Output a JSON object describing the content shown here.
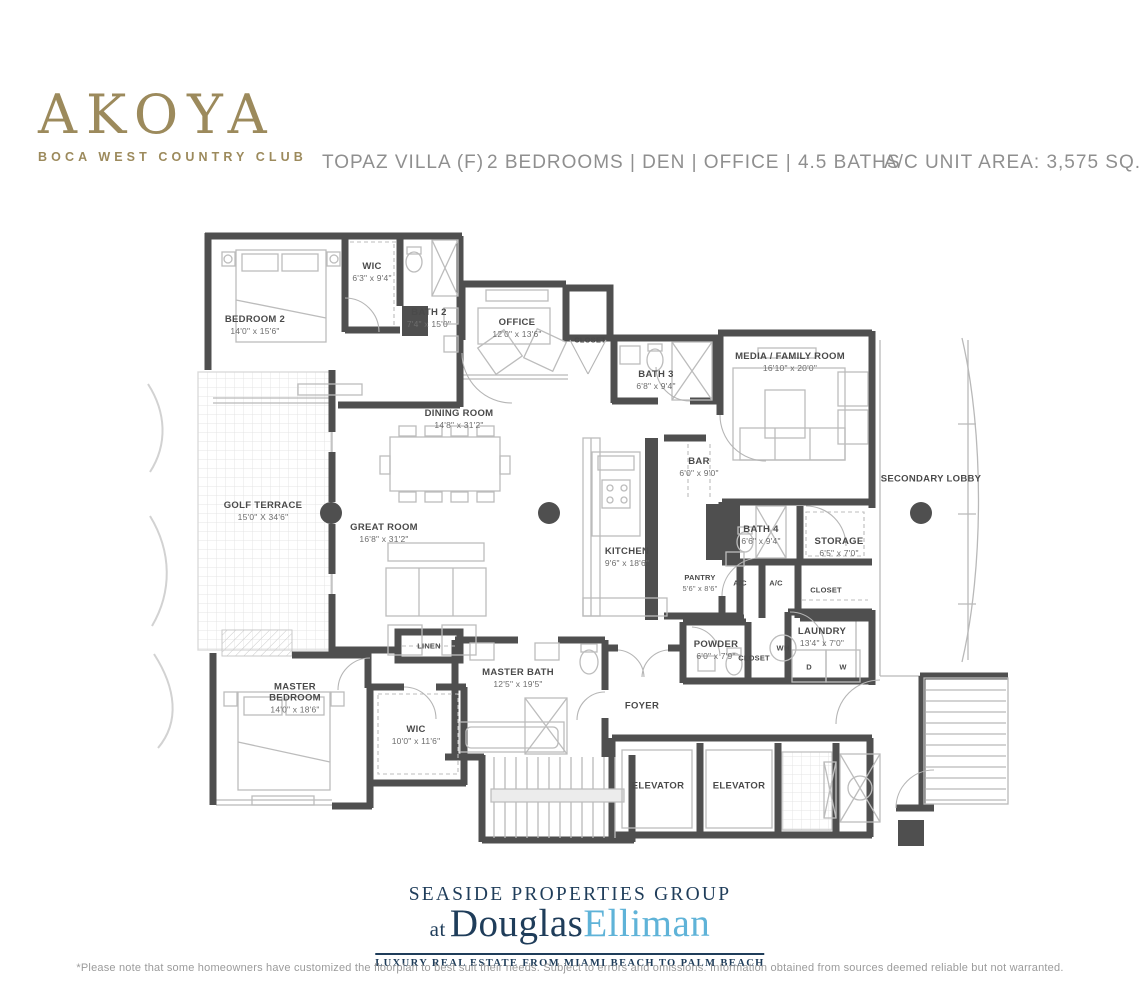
{
  "header": {
    "logo_title": "AKOYA",
    "logo_subtitle": "BOCA WEST COUNTRY CLUB",
    "plan_name": "TOPAZ VILLA (F)",
    "features": "2 BEDROOMS  |  DEN  |  OFFICE  |  4.5 BATHS",
    "area": "A/C UNIT AREA:  3,575 SQ. FT."
  },
  "rooms": [
    {
      "id": "bedroom-2",
      "label": "BEDROOM 2",
      "dims": "14'0\" x 15'6\"",
      "x": 255,
      "y": 325
    },
    {
      "id": "wic-2",
      "label": "WIC",
      "dims": "6'3\" x 9'4\"",
      "x": 372,
      "y": 272
    },
    {
      "id": "bath-2",
      "label": "BATH 2",
      "dims": "7'4\" x 15'0\"",
      "x": 429,
      "y": 318
    },
    {
      "id": "office",
      "label": "OFFICE",
      "dims": "12'0\" x 13'6\"",
      "x": 517,
      "y": 328
    },
    {
      "id": "closet-office",
      "label": "CLOSET",
      "x": 590,
      "y": 340,
      "small": true
    },
    {
      "id": "bath-3",
      "label": "BATH 3",
      "dims": "6'8\" x 9'4\"",
      "x": 656,
      "y": 380
    },
    {
      "id": "media-family-room",
      "label": "MEDIA / FAMILY ROOM",
      "dims": "16'10\" x 20'0\"",
      "x": 790,
      "y": 362
    },
    {
      "id": "secondary-lobby",
      "label": "SECONDARY LOBBY",
      "x": 931,
      "y": 479
    },
    {
      "id": "dining-room",
      "label": "DINING ROOM",
      "dims": "14'8\" x 31'2\"",
      "x": 459,
      "y": 419
    },
    {
      "id": "golf-terrace",
      "label": "GOLF TERRACE",
      "dims": "15'0\" X 34'6\"",
      "x": 263,
      "y": 511
    },
    {
      "id": "great-room",
      "label": "GREAT ROOM",
      "dims": "16'8\" x 31'2\"",
      "x": 384,
      "y": 533
    },
    {
      "id": "bar",
      "label": "BAR",
      "dims": "6'0\" x 9'0\"",
      "x": 699,
      "y": 467
    },
    {
      "id": "kitchen",
      "label": "KITCHEN",
      "dims": "9'6\" x 18'6\"",
      "x": 627,
      "y": 557
    },
    {
      "id": "pantry",
      "label": "PANTRY",
      "dims": "5'6\" x 8'6\"",
      "x": 700,
      "y": 583,
      "small": true
    },
    {
      "id": "bath-4",
      "label": "BATH 4",
      "dims": "6'6\" x 9'4\"",
      "x": 761,
      "y": 535
    },
    {
      "id": "storage",
      "label": "STORAGE",
      "dims": "6'5\" x 7'0\"",
      "x": 839,
      "y": 547
    },
    {
      "id": "ac-1",
      "label": "A/C",
      "x": 740,
      "y": 583,
      "small": true
    },
    {
      "id": "ac-2",
      "label": "A/C",
      "x": 776,
      "y": 583,
      "small": true
    },
    {
      "id": "closet-1",
      "label": "CLOSET",
      "x": 826,
      "y": 590,
      "small": true
    },
    {
      "id": "powder",
      "label": "POWDER",
      "dims": "6'0\" x 7'9\"",
      "x": 716,
      "y": 650
    },
    {
      "id": "closet-2",
      "label": "CLOSET",
      "x": 754,
      "y": 658,
      "small": true
    },
    {
      "id": "wh",
      "label": "WH",
      "x": 783,
      "y": 648,
      "small": true
    },
    {
      "id": "laundry",
      "label": "LAUNDRY",
      "dims": "13'4\" x 7'0\"",
      "x": 822,
      "y": 637
    },
    {
      "id": "dryer",
      "label": "D",
      "x": 809,
      "y": 667,
      "small": true
    },
    {
      "id": "washer",
      "label": "W",
      "x": 843,
      "y": 667,
      "small": true
    },
    {
      "id": "linen",
      "label": "LINEN",
      "x": 429,
      "y": 646,
      "small": true
    },
    {
      "id": "master-bedroom",
      "label": "MASTER BEDROOM",
      "dims": "14'0\" x 18'6\"",
      "x": 295,
      "y": 698,
      "wrap": true
    },
    {
      "id": "master-bath",
      "label": "MASTER BATH",
      "dims": "12'5\" x 19'5\"",
      "x": 518,
      "y": 678
    },
    {
      "id": "wic-master",
      "label": "WIC",
      "dims": "10'0\" x 11'6\"",
      "x": 416,
      "y": 735
    },
    {
      "id": "foyer",
      "label": "FOYER",
      "x": 642,
      "y": 706
    },
    {
      "id": "elevator-1",
      "label": "ELEVATOR",
      "x": 658,
      "y": 786
    },
    {
      "id": "elevator-2",
      "label": "ELEVATOR",
      "x": 739,
      "y": 786
    }
  ],
  "footer": {
    "brand_line": "SEASIDE PROPERTIES GROUP",
    "brand_at": "at",
    "brand_douglas": "Douglas",
    "brand_elliman": "Elliman",
    "tagline": "LUXURY REAL ESTATE FROM MIAMI BEACH TO PALM BEACH",
    "disclaimer": "*Please note that some homeowners have customized the floorplan to best suit their needs. Subject to errors and omissions. Information obtained from sources deemed reliable but not warranted."
  },
  "colors": {
    "gold": "#9c8a5c",
    "navy": "#1f3d5a",
    "light_blue": "#5fb3d8",
    "wall_gray": "#4f4f4f"
  }
}
